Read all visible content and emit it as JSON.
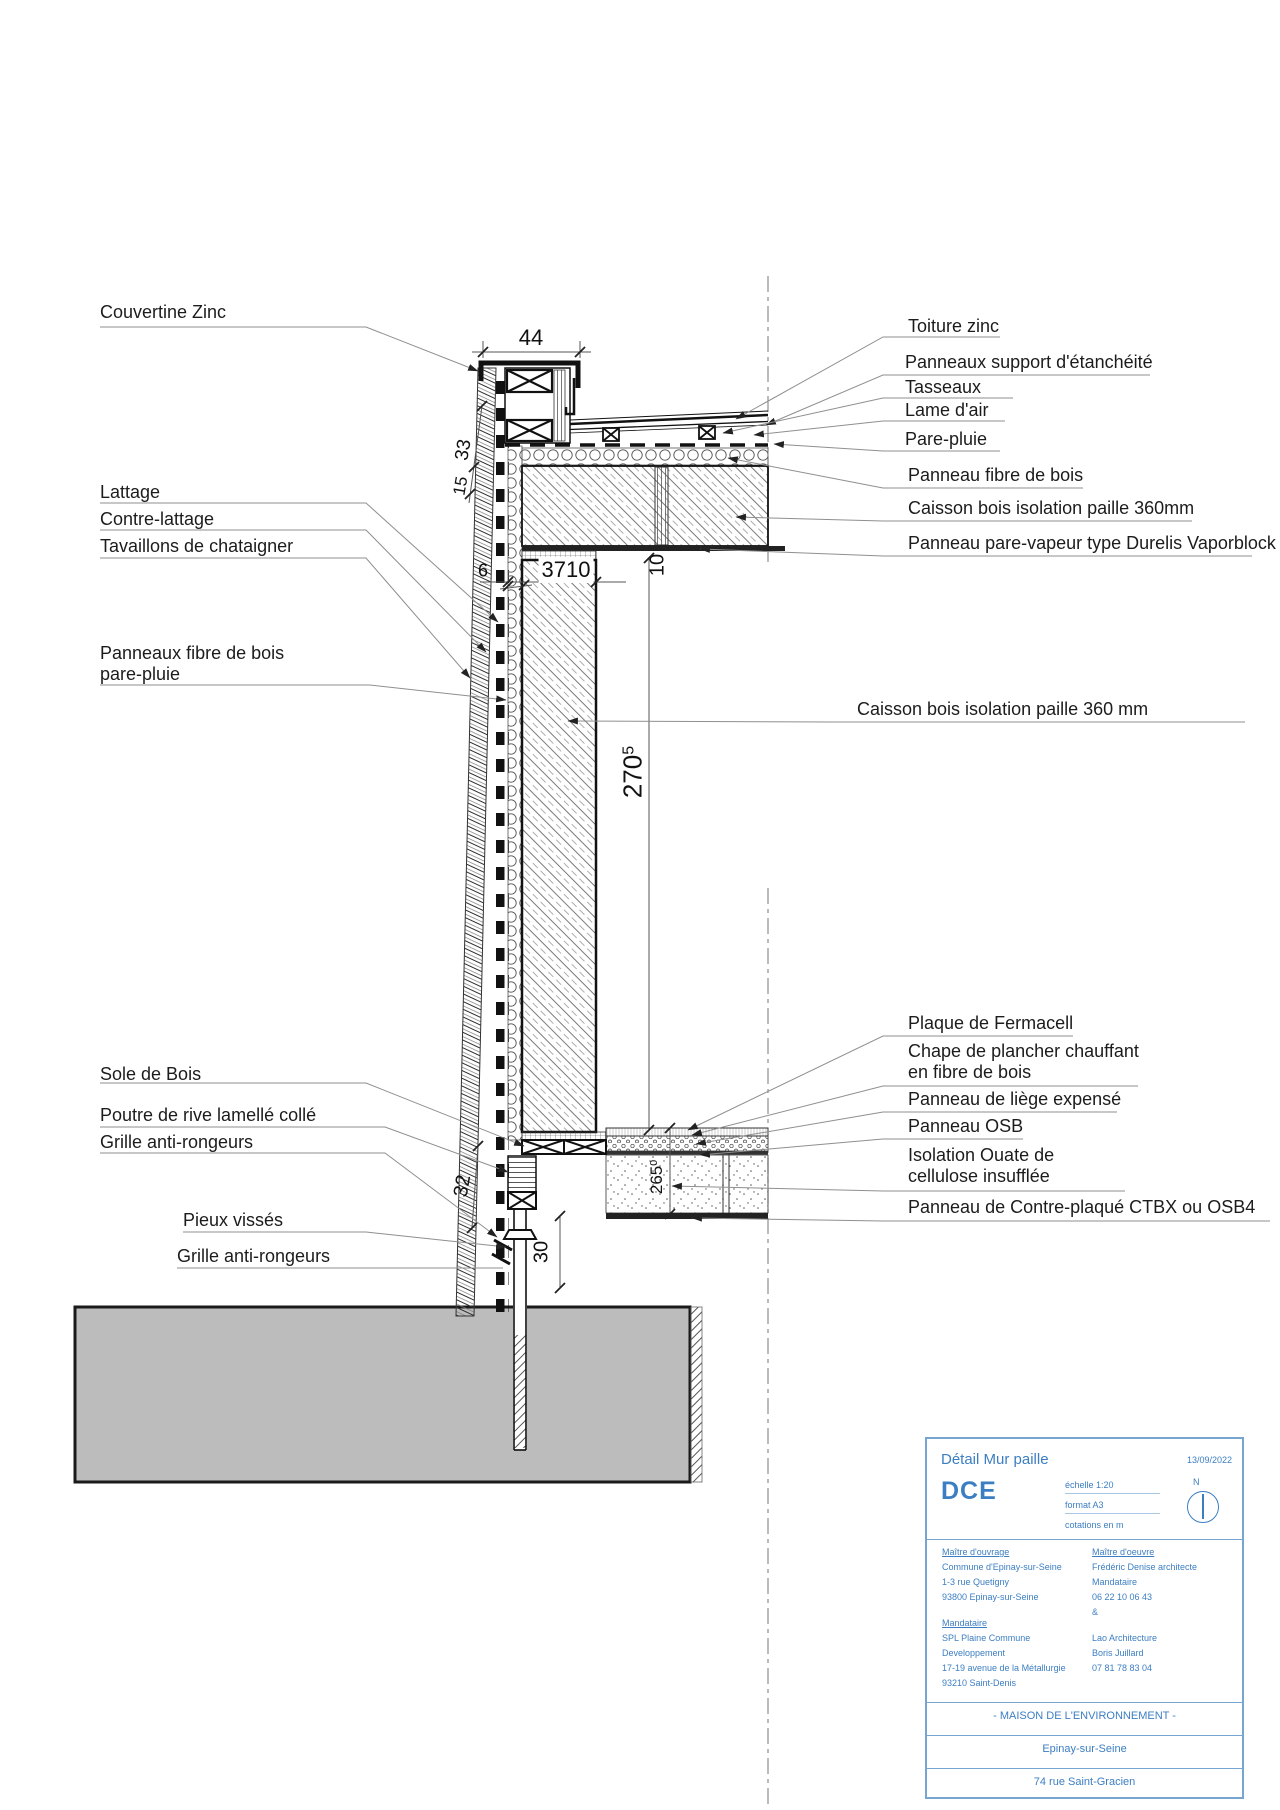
{
  "drawing": {
    "labels_left": [
      {
        "text": "Couvertine Zinc"
      },
      {
        "text": "Lattage"
      },
      {
        "text": "Contre-lattage"
      },
      {
        "text": "Tavaillons de chataigner"
      },
      {
        "text": "Panneaux fibre de bois",
        "text2": "pare-pluie"
      },
      {
        "text": "Sole de Bois"
      },
      {
        "text": "Poutre de rive lamellé collé"
      },
      {
        "text": "Grille anti-rongeurs"
      },
      {
        "text": "Pieux vissés"
      },
      {
        "text": "Grille anti-rongeurs"
      }
    ],
    "labels_right": [
      {
        "text": "Toiture zinc"
      },
      {
        "text": "Panneaux support d'étanchéité"
      },
      {
        "text": "Tasseaux"
      },
      {
        "text": "Lame d'air"
      },
      {
        "text": "Pare-pluie"
      },
      {
        "text": "Panneau fibre de bois"
      },
      {
        "text": "Caisson bois isolation paille 360mm"
      },
      {
        "text": "Panneau pare-vapeur type Durelis Vaporblock"
      },
      {
        "text": "Caisson bois isolation paille 360 mm"
      },
      {
        "text": "Plaque de Fermacell"
      },
      {
        "text": "Chape de plancher chauffant",
        "text2": "en fibre de bois"
      },
      {
        "text": "Panneau de liège expensé"
      },
      {
        "text": "Panneau OSB"
      },
      {
        "text": "Isolation Ouate de",
        "text2": "cellulose insufflée"
      },
      {
        "text": "Panneau de Contre-plaqué CTBX ou OSB4"
      }
    ],
    "dims": {
      "parapet_width": "44",
      "cladding_upper": "33",
      "cladding_lower": "15",
      "fiber_panel": "6",
      "wall_total": "3710",
      "roof_panel": "10",
      "wall_height": "270",
      "wall_height_sup": "5",
      "plinth": "32",
      "pile_offset": "30",
      "floor_depth": "265",
      "floor_depth_sup": "0"
    }
  },
  "title_block": {
    "title": "Détail Mur paille",
    "date": "13/09/2022",
    "phase": "DCE",
    "scale": "échelle 1:20",
    "format": "format A3",
    "units": "cotations en m",
    "north_letter": "N",
    "owner_heading": "Maître d'ouvrage",
    "owner_lines": [
      "Commune d'Epinay-sur-Seine",
      "1-3 rue Quetigny",
      "93800 Epinay-sur-Seine"
    ],
    "agent_heading": "Mandataire",
    "agent_lines": [
      "SPL Plaine Commune",
      "Developpement",
      "17-19 avenue de la Métallurgie",
      "93210 Saint-Denis"
    ],
    "architect_heading": "Maître d'oeuvre",
    "architect_lines": [
      "Frédéric Denise architecte",
      "Mandataire",
      "06 22 10 06 43",
      "&"
    ],
    "architect2_lines": [
      "Lao Architecture",
      "Boris Juillard",
      "07 81 78 83 04"
    ],
    "project": "- MAISON DE L'ENVIRONNEMENT -",
    "city": "Epinay-sur-Seine",
    "address": "74 rue Saint-Gracien"
  }
}
